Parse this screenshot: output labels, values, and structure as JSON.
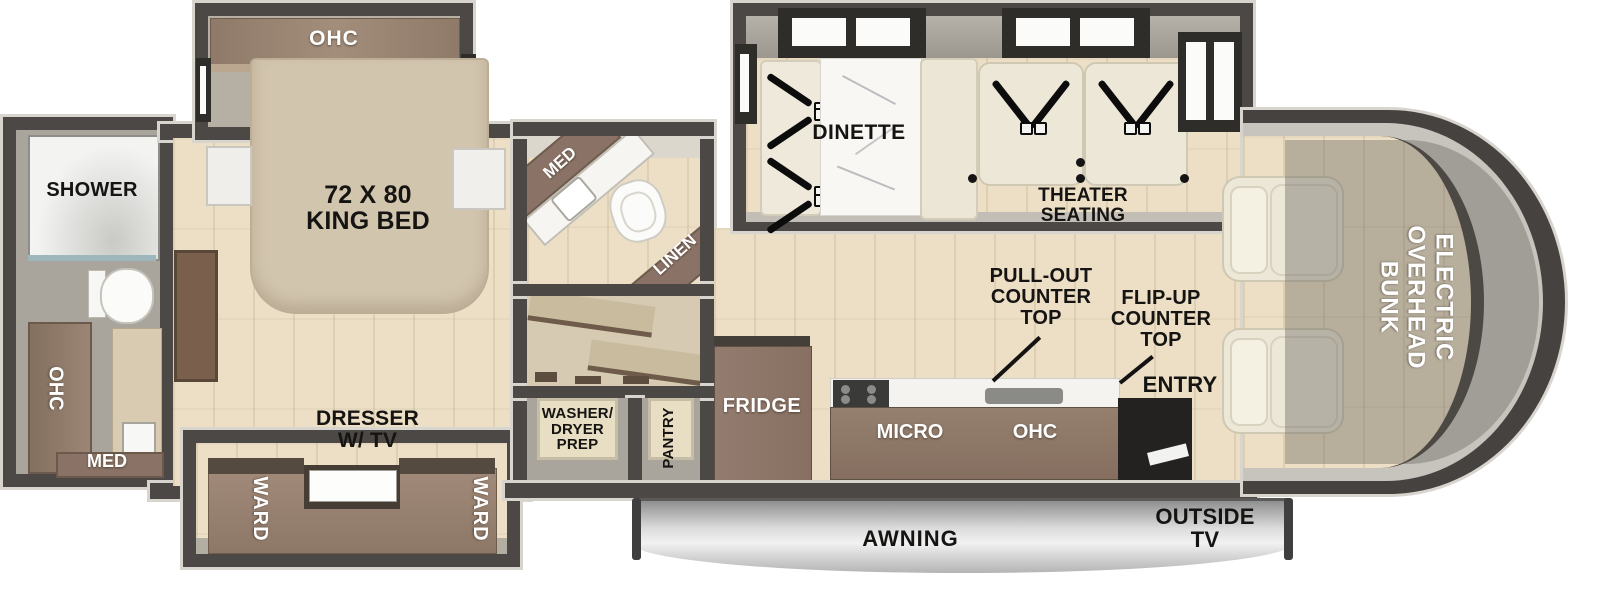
{
  "floorplan": {
    "bath_left": {
      "shower": "SHOWER",
      "ohc": "OHC",
      "med": "MED"
    },
    "bedroom": {
      "ohc": "OHC",
      "king_bed": "72 X 80\nKING BED",
      "dresser": "DRESSER\nW/ TV",
      "ward_left": "WARD",
      "ward_right": "WARD"
    },
    "bath_mid": {
      "med": "MED",
      "linen": "LINEN"
    },
    "utility": {
      "washer": "WASHER/\nDRYER\nPREP",
      "pantry": "PANTRY"
    },
    "living": {
      "dinette": "DINETTE",
      "theater": "THEATER\nSEATING"
    },
    "kitchen": {
      "fridge": "FRIDGE",
      "micro": "MICRO",
      "ohc": "OHC",
      "pullout": "PULL-OUT\nCOUNTER\nTOP",
      "flipup": "FLIP-UP\nCOUNTER\nTOP",
      "entry": "ENTRY"
    },
    "cab": {
      "bunk": "ELECTRIC\nOVERHEAD\nBUNK"
    },
    "exterior": {
      "awning": "AWNING",
      "outside_tv": "OUTSIDE\nTV"
    }
  },
  "colors": {
    "wall": "#4b4845",
    "floor": "#ecdfc6",
    "cabinet_brown": "#8a7366",
    "bed_beige": "#d2c5ae",
    "seat_cream": "#ece7d7",
    "awning_silver": "#d9d9d9"
  }
}
